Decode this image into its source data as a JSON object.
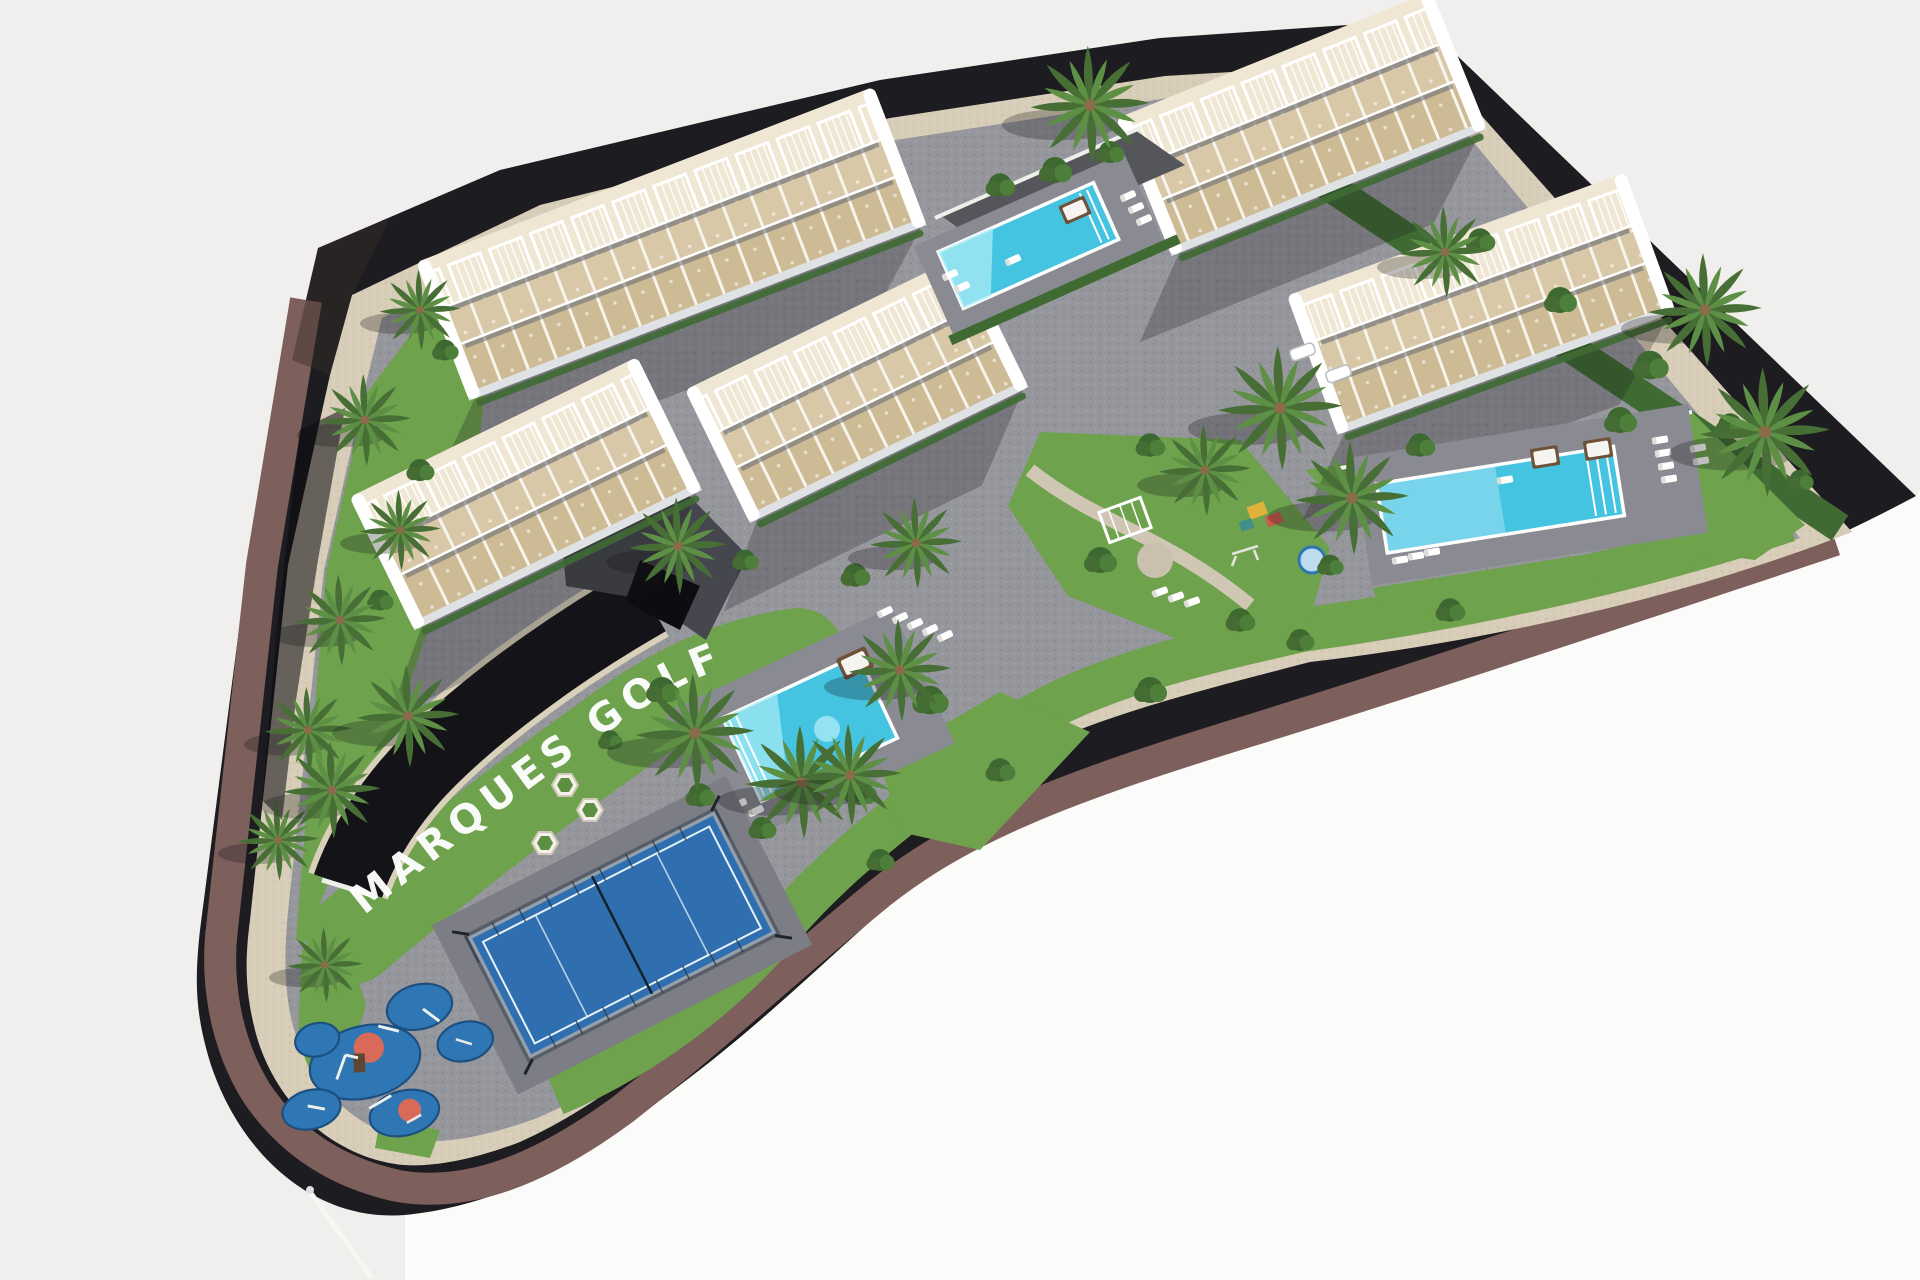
{
  "scene": {
    "title": "Aerial 3D render of the Marques Golf residential complex",
    "site_label": "MARQUES GOLF",
    "features": {
      "apartment_buildings": 5,
      "swimming_pools": 3,
      "padel_courts": 1,
      "playgrounds": 2
    }
  },
  "colors": {
    "background": "#f0efed",
    "background_white": "#fbfbfa",
    "road": "#1d1c20",
    "ramp": "#141318",
    "sidewalk": "#7d5f5c",
    "stone": "#d8cdb8",
    "paving": "#96969d",
    "paving_light": "#8a8b92",
    "paving_dark": "#7c7d85",
    "grass": "#6ea24d",
    "grass_dark": "#3f6b33",
    "building": "#ffffff",
    "building_shade": "#dfe2e4",
    "terrace": "#d9c8a7",
    "terrace_dark": "#cdbb96",
    "roof": "#efe7d3",
    "window": "#5a616b",
    "pool": "#45c4e2",
    "pool_light": "#a9ecf5",
    "padel_court": "#2f6fb0",
    "padel_frame": "#22303c",
    "playground": "#2e77b4",
    "playground_accent": "#d96a5a",
    "palm": "#5d8f45",
    "palm_dark": "#476f35",
    "shadow": "#17171c",
    "wall_white": "#efece4",
    "label_text": "#ffffff"
  }
}
